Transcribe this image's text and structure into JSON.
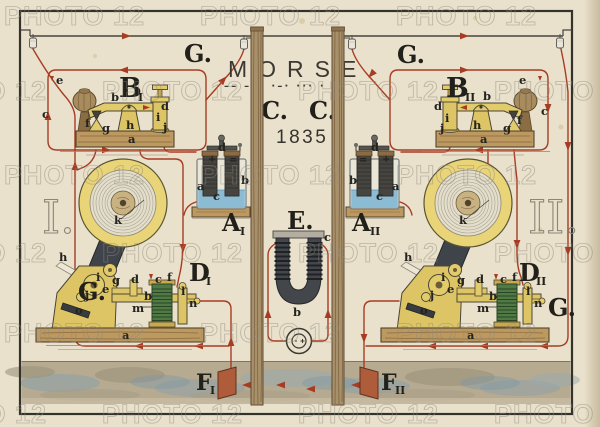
{
  "watermark": {
    "text": "PHOTO 12"
  },
  "header": {
    "title": "MORSE",
    "morse_code": "–– ––– ·–· ··· ·",
    "station_left_mark": "C.",
    "station_right_mark": "C.",
    "year": "1835"
  },
  "line_label": "G.",
  "magnet": {
    "label": "E."
  },
  "stations": {
    "left": {
      "numeral": "I.",
      "key_label": "B",
      "key_sub": "I",
      "battery_label": "A",
      "battery_sub": "I",
      "register_label": "D",
      "register_sub": "I",
      "earth_label": "F",
      "earth_sub": "I"
    },
    "right": {
      "numeral": "II.",
      "key_label": "B",
      "key_sub": "II",
      "battery_label": "A",
      "battery_sub": "II",
      "register_label": "D",
      "register_sub": "II",
      "earth_label": "F",
      "earth_sub": "II"
    }
  },
  "letters": {
    "a": "a",
    "b": "b",
    "c": "c",
    "d": "d",
    "e": "e",
    "f": "f",
    "g": "g",
    "h": "h",
    "i": "i",
    "j": "j",
    "k": "k",
    "l": "l",
    "m": "m",
    "n": "n",
    "o": "o",
    "plus": "+",
    "equals": "="
  },
  "colors": {
    "paper": "#e9e1cb",
    "ink_red": "#a73c24",
    "brass": "#e2cb6a",
    "wood": "#bb9960",
    "ground_blue": "#8ba0aa",
    "magnet_dark": "#43464b",
    "earth_plate": "#ae5c39",
    "battery_liquid": "#8cbcd4",
    "coil_green": "#4f7a44",
    "frame_ink": "#33322c"
  }
}
